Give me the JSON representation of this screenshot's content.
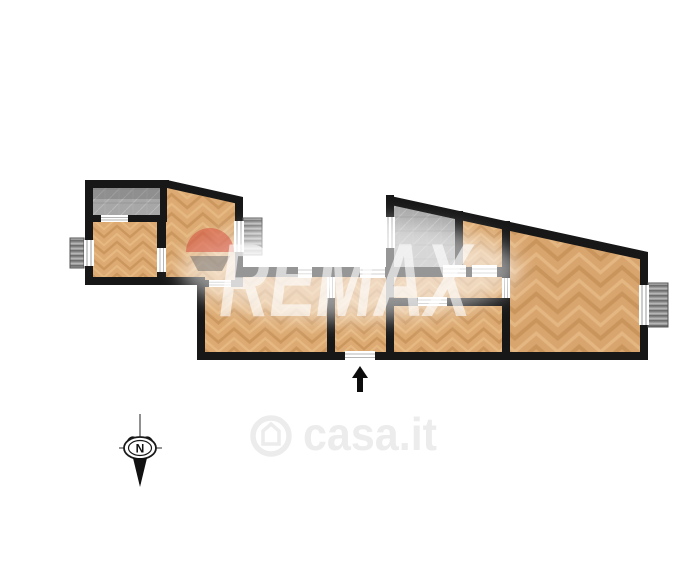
{
  "page": {
    "width": 681,
    "height": 588,
    "background": "#ffffff",
    "title": "Apartment floor plan"
  },
  "floorplan": {
    "wall_color": "#171717",
    "floor_colors": {
      "wood_base": "#dcaa72",
      "wood_grain_dark": "#bf8a52",
      "wood_grain_light": "#efc58f",
      "tile_base": "#a7a7a7",
      "balcony_hatch": "#9a9a9a"
    },
    "rooms": [
      {
        "name": "storage-room-left",
        "floor": "gray-tile"
      },
      {
        "name": "bedroom-left",
        "floor": "wood-herringbone"
      },
      {
        "name": "room-left-upper",
        "floor": "wood-herringbone"
      },
      {
        "name": "living-room",
        "floor": "wood-herringbone"
      },
      {
        "name": "entry-room",
        "floor": "wood-herringbone"
      },
      {
        "name": "hallway",
        "floor": "wood-herringbone"
      },
      {
        "name": "bedroom-middle",
        "floor": "wood-herringbone"
      },
      {
        "name": "bathroom",
        "floor": "gray-tile"
      },
      {
        "name": "closet-room",
        "floor": "wood-herringbone"
      },
      {
        "name": "living-room-right",
        "floor": "wood-herringbone"
      }
    ],
    "window_count": 6,
    "entrance": {
      "direction": "up",
      "location": "bottom-center"
    }
  },
  "watermarks": {
    "remax": {
      "text": "REMAX",
      "color": "rgba(255,255,255,0.62)",
      "balloon_red": "rgba(214,80,66,0.55)",
      "balloon_gray": "rgba(105,105,105,0.5)"
    },
    "casa": {
      "text": "casa.it",
      "color": "#ececec"
    }
  },
  "compass": {
    "north_label": "N"
  }
}
